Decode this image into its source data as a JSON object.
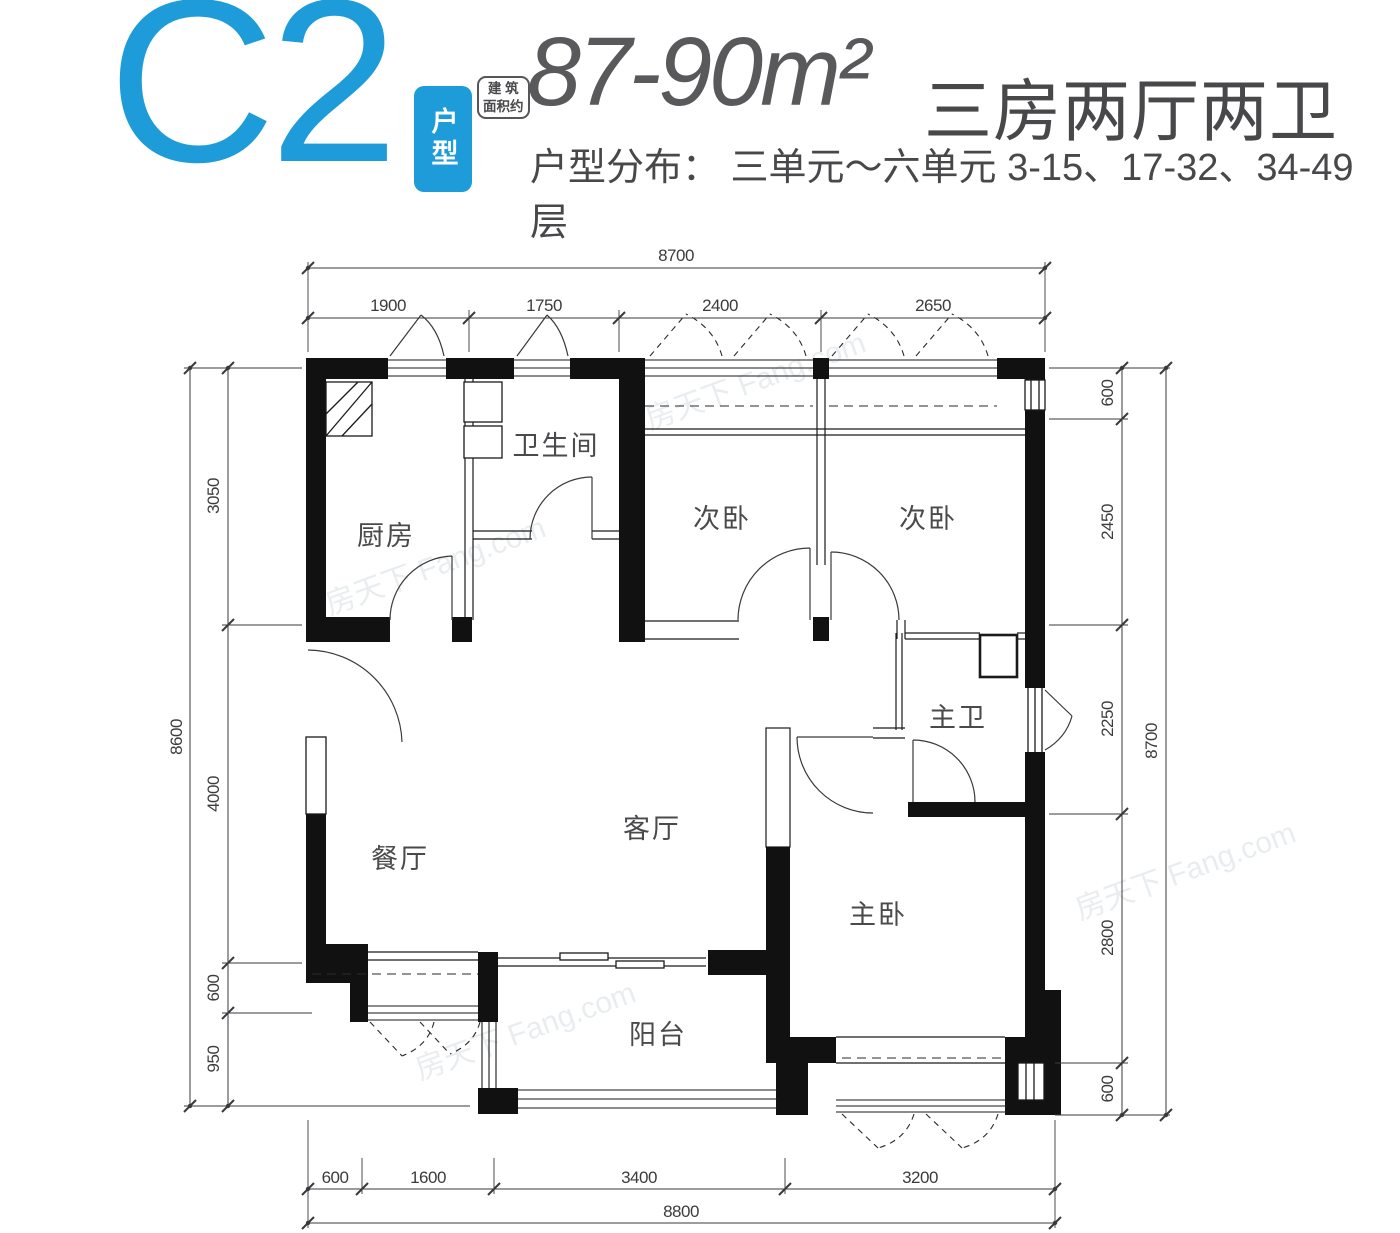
{
  "header": {
    "plan_code": "C2",
    "plan_badge": "户型",
    "area_note_line1": "建 筑",
    "area_note_line2": "面积约",
    "area": "87-90m²",
    "rooms_summary": "三房两厅两卫",
    "distribution": "户型分布： 三单元～六单元 3-15、17-32、34-49 层"
  },
  "plan": {
    "rooms": {
      "kitchen": "厨房",
      "bath": "卫生间",
      "bedroom2a": "次卧",
      "bedroom2b": "次卧",
      "master_bath": "主卫",
      "living": "客厅",
      "dining": "餐厅",
      "master_bedroom": "主卧",
      "balcony": "阳台"
    },
    "dims": {
      "top": {
        "overall": "8700",
        "segments": [
          "1900",
          "1750",
          "2400",
          "2650"
        ]
      },
      "bottom": {
        "overall": "8800",
        "segments": [
          "600",
          "1600",
          "3400",
          "3200"
        ]
      },
      "left": {
        "overall": "8600",
        "segments": [
          "3050",
          "4000",
          "600",
          "950"
        ]
      },
      "right": {
        "overall": "8700",
        "segments": [
          "600",
          "2450",
          "2250",
          "2800",
          "600"
        ]
      }
    },
    "watermark": "房天下 Fang.com"
  },
  "colors": {
    "accent": "#1E9CD9",
    "text_dark": "#4A4A4C",
    "wall": "#111111"
  }
}
